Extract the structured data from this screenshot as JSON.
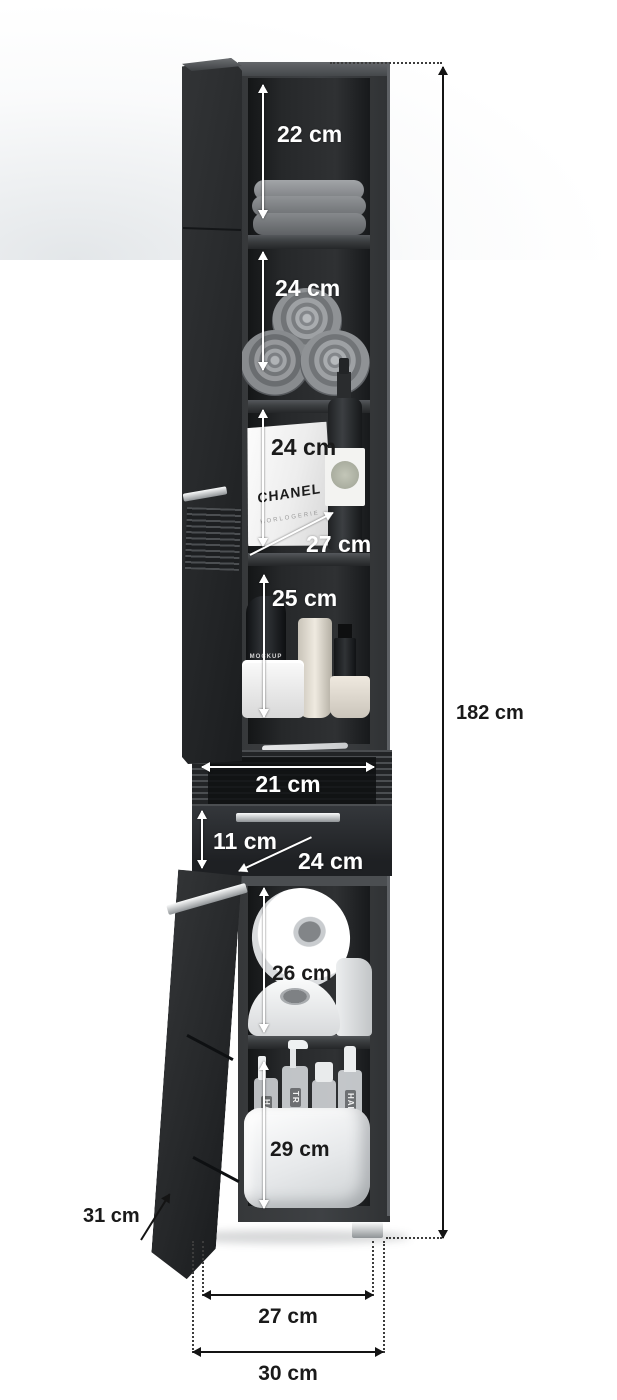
{
  "diagram": {
    "dimensions": {
      "comp1_height": "22 cm",
      "comp2_height": "24 cm",
      "comp3_height": "24 cm",
      "comp3_depth": "27 cm",
      "comp4_height": "25 cm",
      "drawer_inner_width": "21 cm",
      "drawer_front_height": "11 cm",
      "drawer_depth": "24 cm",
      "comp5_height": "26 cm",
      "comp6_height": "29 cm",
      "overall_height": "182 cm",
      "overall_depth": "31 cm",
      "feet_span": "27 cm",
      "overall_width": "30 cm"
    },
    "item_texts": {
      "bag_brand": "CHANEL",
      "bag_subtitle": "HORLOGERIE",
      "bottle_text_1": "MOCKUP",
      "bottle_text_2": "DESIGN",
      "spray_label_a": "HAIR",
      "spray_label_b": "TR",
      "spray_label_c": "HAIR"
    },
    "colors": {
      "cabinet_body": "#3a3c3e",
      "cabinet_interior": "#232527",
      "annotation_light": "#ffffff",
      "annotation_dark": "#1a1a1a",
      "metal_accent": "#c6c9cc",
      "background": "#ffffff"
    }
  }
}
